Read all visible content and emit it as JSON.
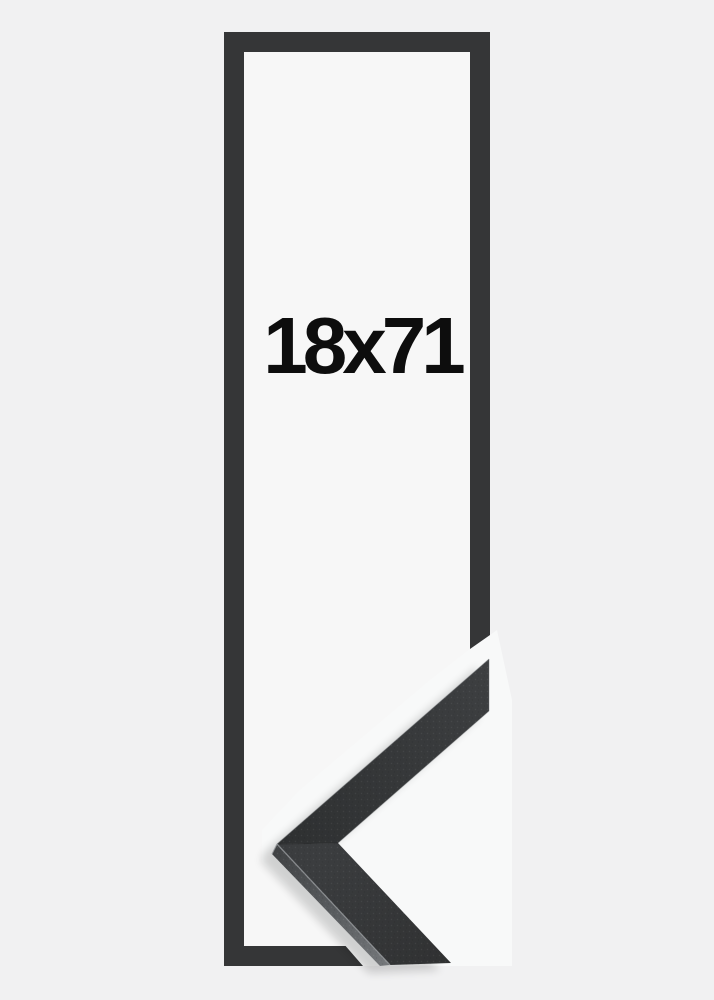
{
  "product": {
    "size_label": "18x71"
  },
  "colors": {
    "background": "#f1f1f2",
    "frame_interior": "#f7f7f7",
    "frame_outline": "#353637",
    "label_text": "#0d0d0d",
    "cutout_white": "#f8f9f9",
    "moulding_face": "#353739",
    "moulding_side": "#6e7174",
    "edge_highlight": "#9b9ea1"
  }
}
